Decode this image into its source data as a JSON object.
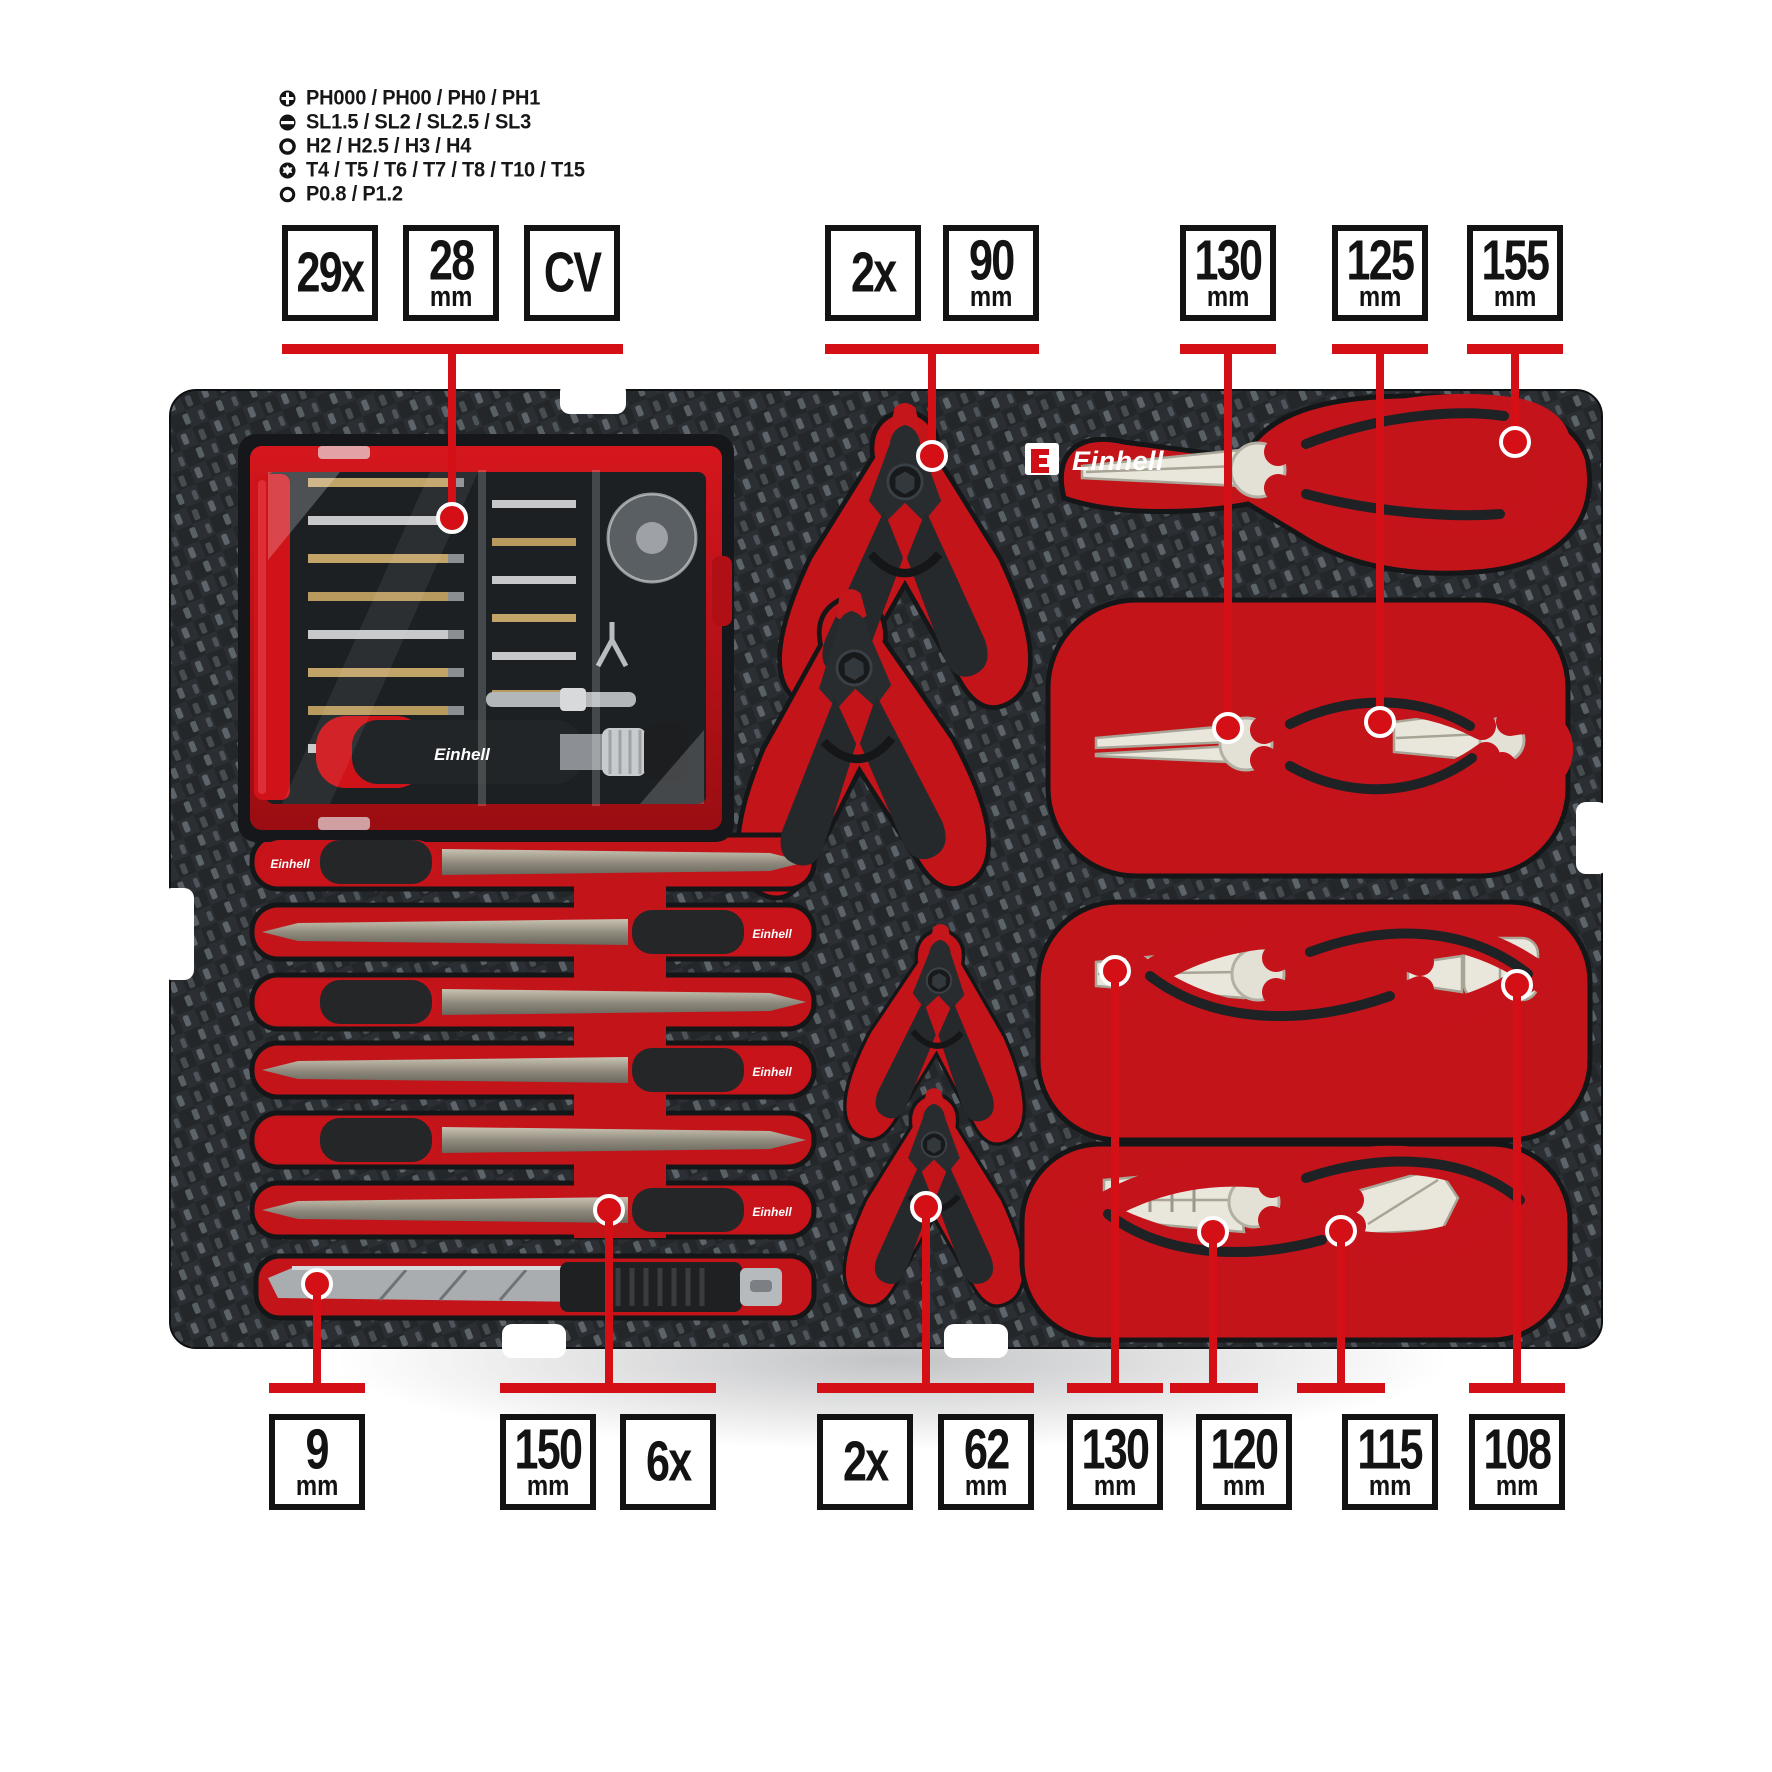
{
  "brand": {
    "name": "Einhell"
  },
  "legend": {
    "items": [
      {
        "icon": "phillips-icon",
        "text": "PH000 / PH00 / PH0 / PH1"
      },
      {
        "icon": "slotted-icon",
        "text": "SL1.5 / SL2 / SL2.5 / SL3"
      },
      {
        "icon": "hex-icon",
        "text": "H2 / H2.5 / H3 / H4"
      },
      {
        "icon": "torx-icon",
        "text": "T4 / T5 / T6 / T7 / T8 / T10 / T15"
      },
      {
        "icon": "pentalobe-icon",
        "text": "P0.8 / P1.2"
      }
    ]
  },
  "callouts": {
    "top_groups": [
      {
        "name": "bit-set",
        "boxes": [
          {
            "value": "29x"
          },
          {
            "value": "28",
            "unit": "mm"
          },
          {
            "value": "CV"
          }
        ]
      },
      {
        "name": "spring-clamps-large",
        "boxes": [
          {
            "value": "2x"
          },
          {
            "value": "90",
            "unit": "mm"
          }
        ]
      },
      {
        "name": "round-nose-pliers",
        "boxes": [
          {
            "value": "130",
            "unit": "mm"
          }
        ]
      },
      {
        "name": "bent-nose-pliers",
        "boxes": [
          {
            "value": "125",
            "unit": "mm"
          }
        ]
      },
      {
        "name": "long-nose-pliers",
        "boxes": [
          {
            "value": "155",
            "unit": "mm"
          }
        ]
      }
    ],
    "bottom_groups": [
      {
        "name": "utility-knife",
        "boxes": [
          {
            "value": "9",
            "unit": "mm"
          }
        ]
      },
      {
        "name": "needle-files",
        "boxes": [
          {
            "value": "150",
            "unit": "mm"
          },
          {
            "value": "6x"
          }
        ]
      },
      {
        "name": "spring-clamps-small",
        "boxes": [
          {
            "value": "2x"
          },
          {
            "value": "62",
            "unit": "mm"
          }
        ]
      },
      {
        "name": "flat-nose-pliers",
        "boxes": [
          {
            "value": "130",
            "unit": "mm"
          }
        ]
      },
      {
        "name": "combination-pliers",
        "boxes": [
          {
            "value": "120",
            "unit": "mm"
          }
        ]
      },
      {
        "name": "diagonal-cutting-pliers",
        "boxes": [
          {
            "value": "115",
            "unit": "mm"
          }
        ]
      },
      {
        "name": "end-cutting-pliers",
        "boxes": [
          {
            "value": "108",
            "unit": "mm"
          }
        ]
      }
    ]
  },
  "colors": {
    "accent_red": "#d50f16",
    "foam_recess_red": "#c3141a",
    "foam_dark": "#24272a",
    "box_border": "#131313"
  }
}
